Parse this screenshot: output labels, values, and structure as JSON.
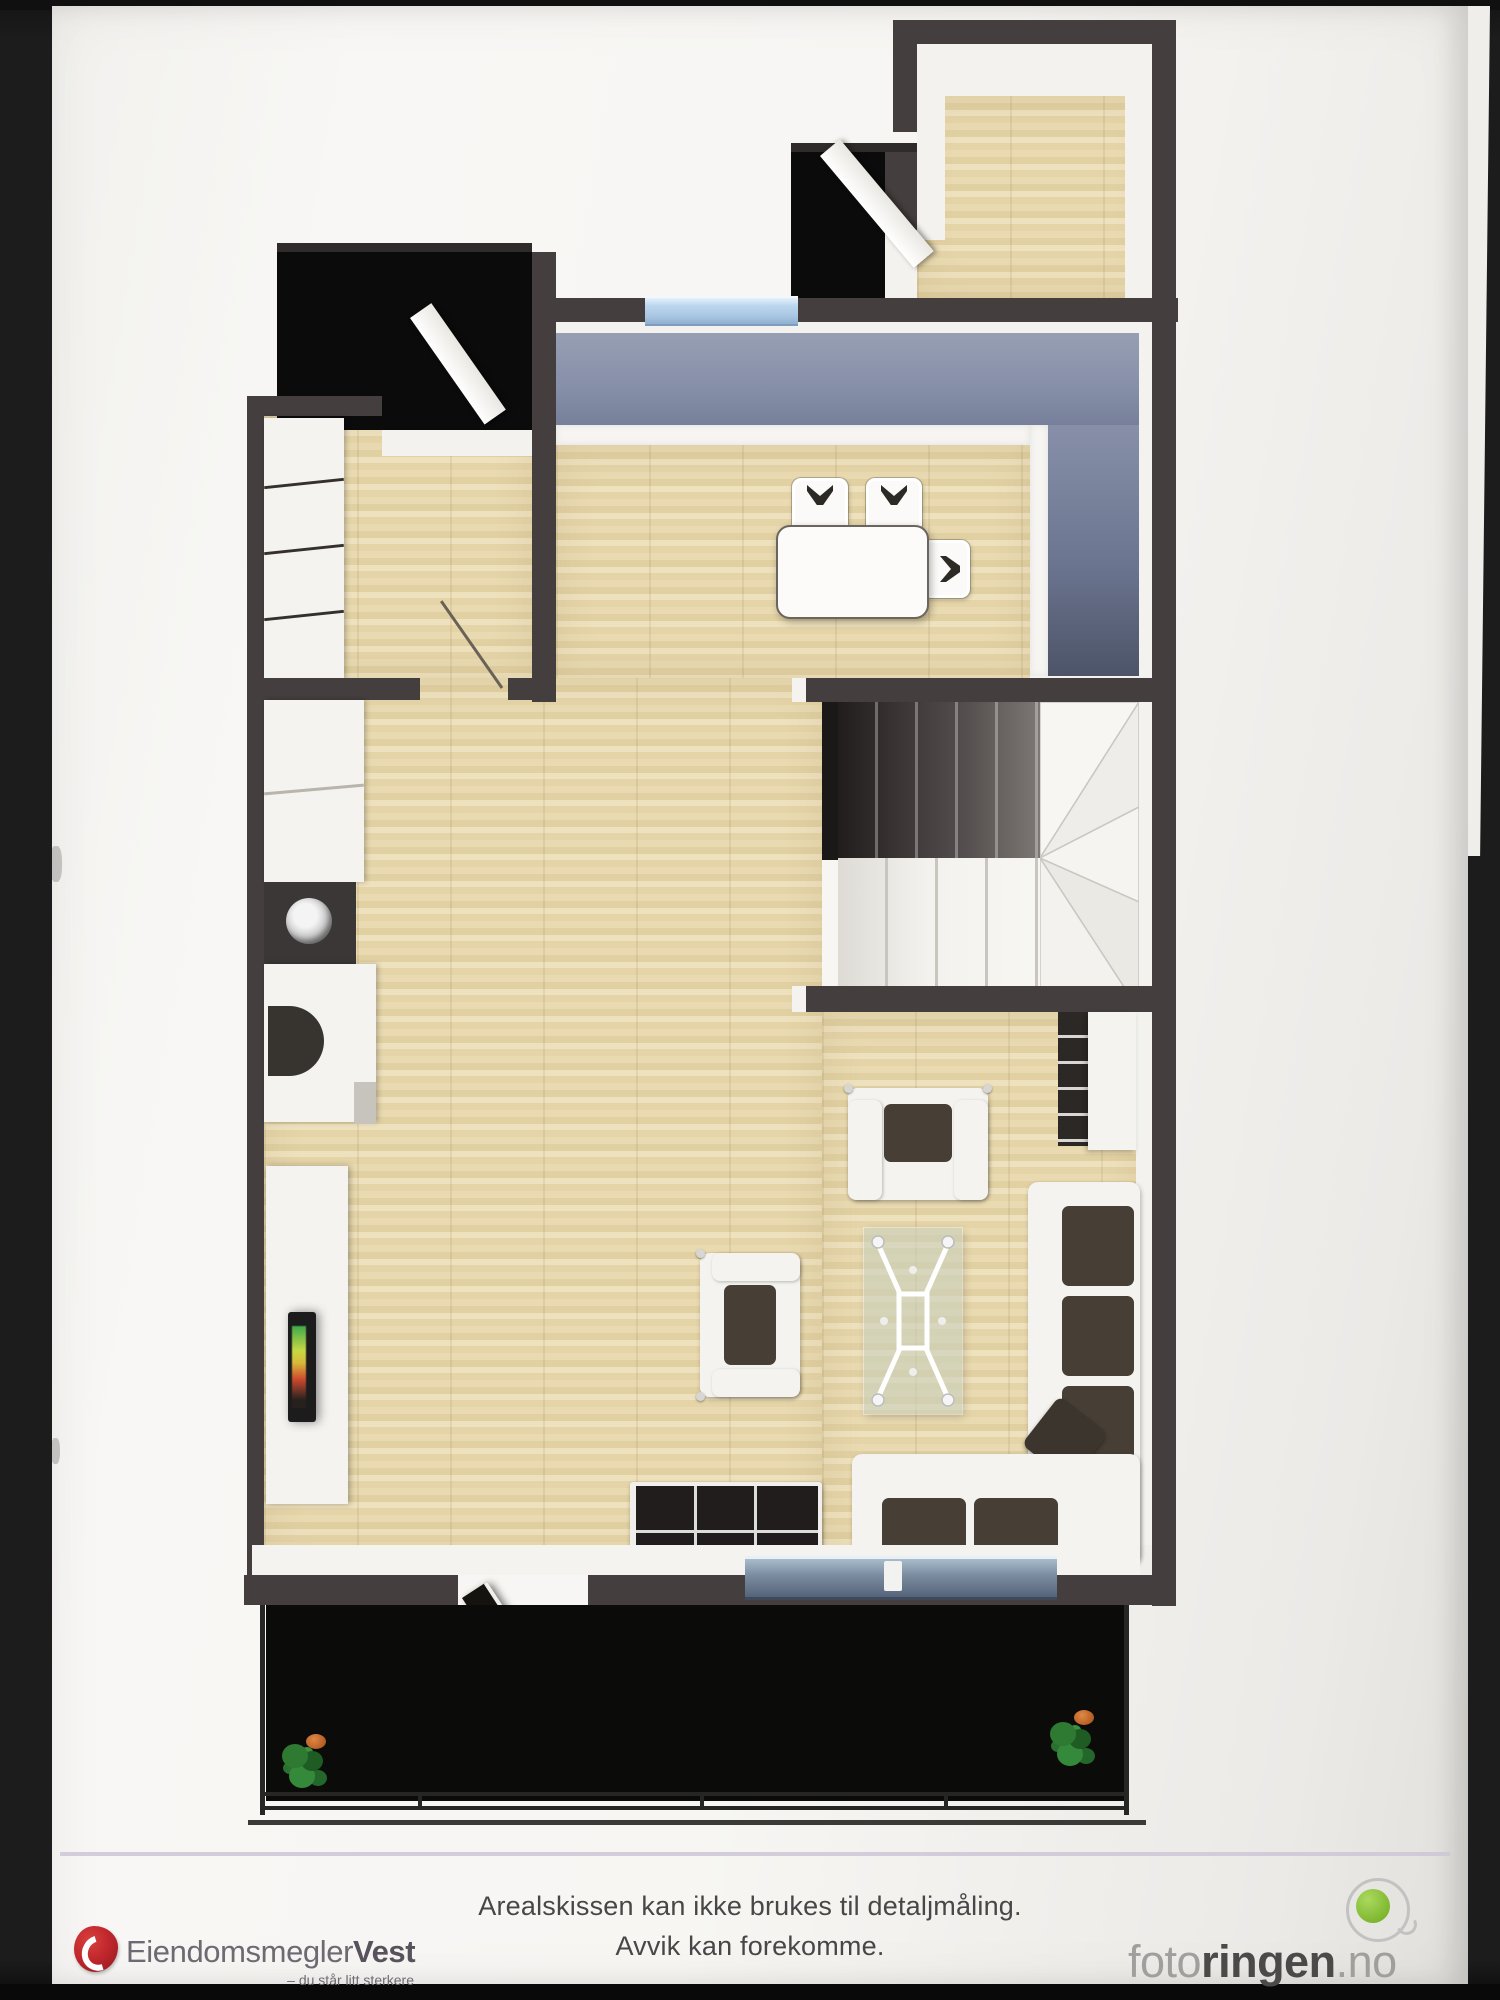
{
  "page": {
    "disclaimer": {
      "line1": "Arealskissen kan ikke brukes til detaljmåling.",
      "line2": "Avvik kan forekomme."
    },
    "brand_left": {
      "name_part1": "Eiendomsmegler",
      "name_part2": "Vest",
      "tagline": "– du står litt sterkere",
      "logo_color": "#c1272d"
    },
    "brand_right": {
      "name_part1": "foto",
      "name_part2": "ringen",
      "name_part3": ".no",
      "logo_green": "#8dc63f",
      "ring_gray": "#c2c2c2"
    }
  },
  "floorplan": {
    "style": "3d-top-down-rendering",
    "palette": {
      "wall": "#443e3e",
      "void_black": "#0b0b0b",
      "wood_floor": "#e6d6ac",
      "accent_wall_blue": "#8b93a9",
      "window_glass": "#b9d3ec",
      "sliding_door": "#6f7f95",
      "white_furniture": "#f4f3f0",
      "dark_cushion": "#473f36",
      "balcony_floor": "#0b0c09"
    },
    "rooms": [
      "entry",
      "entrance-vestibule",
      "storage-room",
      "wardrobe-hallway",
      "kitchen",
      "living-room",
      "dining-area",
      "staircase",
      "balcony"
    ],
    "furniture": [
      "wardrobe-cabinets",
      "kitchen-counter",
      "kitchen-sink",
      "kitchen-appliance",
      "dining-table",
      "dining-chairs",
      "tv-sideboard",
      "tv",
      "bookshelf",
      "shelf-unit",
      "corner-sofa",
      "armchair",
      "loveseat",
      "glass-coffee-table",
      "dark-sideboard",
      "potted-plants",
      "sliding-glass-door",
      "balcony-railing",
      "open-doors"
    ]
  }
}
